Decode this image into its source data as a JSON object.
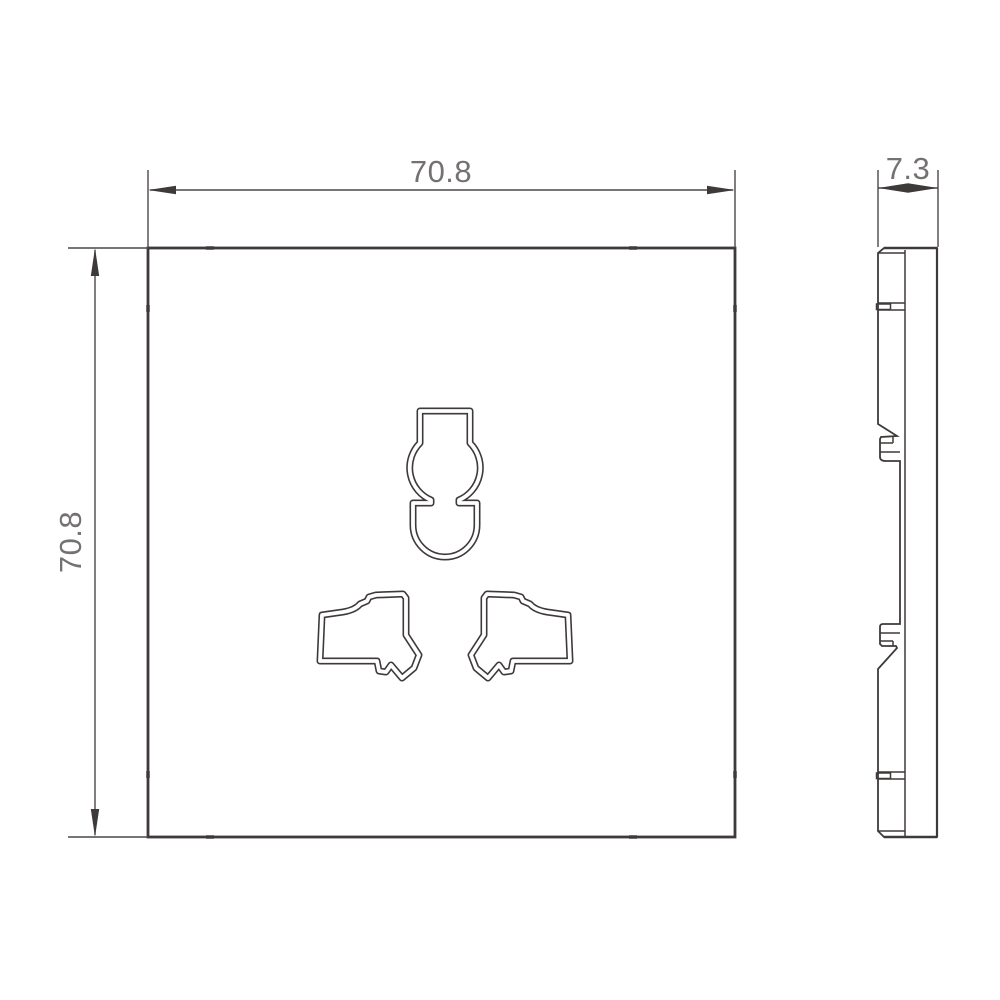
{
  "drawing": {
    "type": "technical-dimension-drawing",
    "dim_width": "70.8",
    "dim_height": "70.8",
    "dim_thickness": "7.3",
    "colors": {
      "line": "#3e3a39",
      "dimension_line": "#4c4847",
      "text": "#757173",
      "background": "#ffffff"
    }
  }
}
